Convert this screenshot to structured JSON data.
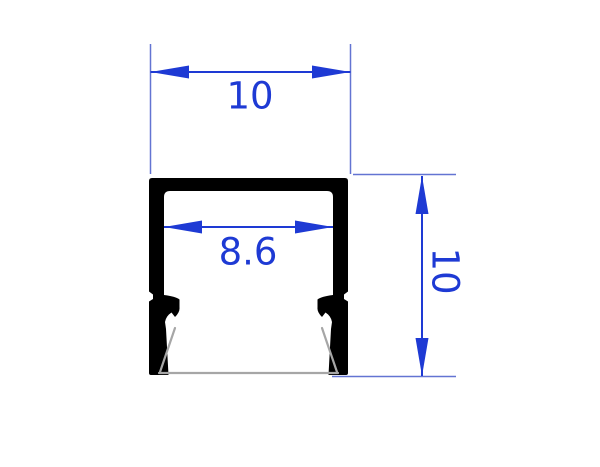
{
  "drawing": {
    "labels": {
      "outer_width": "10",
      "inner_width": "8.6",
      "height": "10"
    },
    "colors": {
      "dimension": "#1e3ad4",
      "extension": "#6374d2",
      "profile": "#000000",
      "base": "#a6a6a6",
      "background": "#ffffff"
    }
  }
}
